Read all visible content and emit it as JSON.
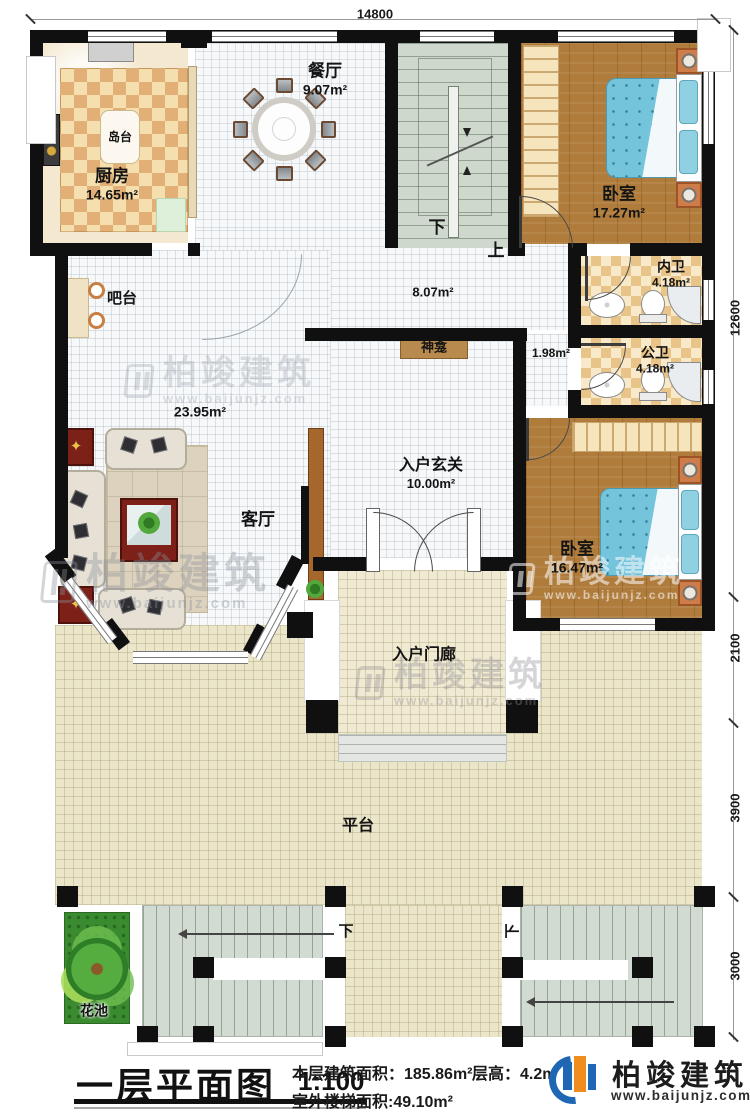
{
  "plan": {
    "title": "一层平面图",
    "scale": "1:100",
    "dimensions": {
      "top_width": "14800",
      "right_house": "12600",
      "right_porch": "2100",
      "right_platform": "3900",
      "right_stairs": "3000"
    },
    "rooms": {
      "kitchen": {
        "name": "厨房",
        "area": "14.65m²"
      },
      "island": {
        "name": "岛台"
      },
      "dining": {
        "name": "餐厅",
        "area": "9.07m²"
      },
      "bar": {
        "name": "吧台"
      },
      "stair_down": "下",
      "stair_up": "上",
      "bedroom_top": {
        "name": "卧室",
        "area": "17.27m²"
      },
      "bath_inner": {
        "name": "内卫",
        "area": "4.18m²"
      },
      "bath_public": {
        "name": "公卫",
        "area": "4.18m²"
      },
      "hallway": {
        "area": "8.07m²"
      },
      "nook": {
        "area": "1.98m²"
      },
      "shrine": {
        "name": "神龛"
      },
      "living": {
        "name": "客厅",
        "area": "23.95m²"
      },
      "foyer": {
        "name": "入户玄关",
        "area": "10.00m²"
      },
      "bedroom_lower": {
        "name": "卧室",
        "area": "16.47m²"
      },
      "porch": {
        "name": "入户门廊"
      },
      "platform": {
        "name": "平台"
      },
      "flower_bed": {
        "name": "花池"
      },
      "stair_left_down": "下",
      "stair_right_down": "下"
    },
    "footer": {
      "floor_area_label": "本层建筑面积：185.86m²",
      "floor_height_label": "层高：4.2m",
      "stair_area_label": "室外楼梯面积:49.10m²",
      "brand": "柏竣建筑",
      "website": "www.baijunjz.com"
    },
    "watermark": {
      "brand": "柏竣建筑",
      "website": "www.baijunjz.com"
    }
  }
}
